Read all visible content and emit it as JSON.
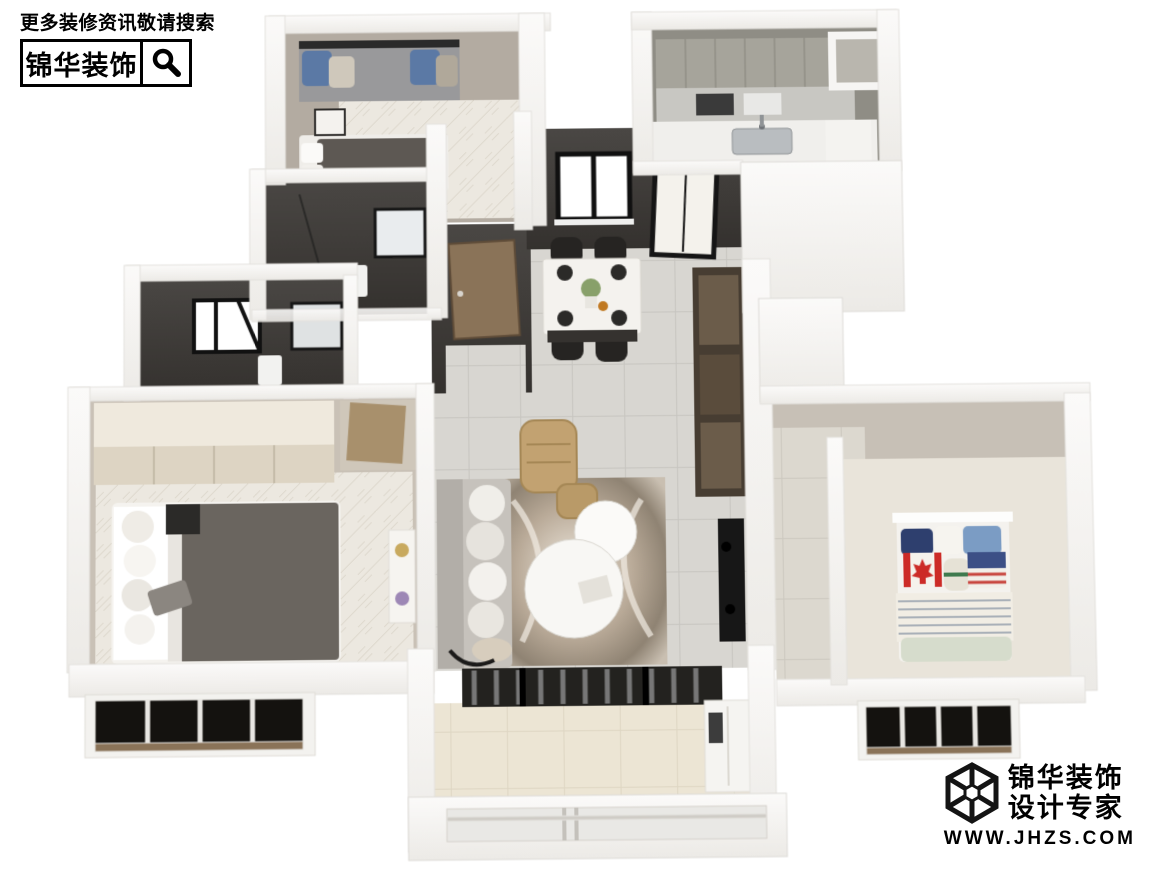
{
  "watermark_top": {
    "tagline": "更多装修资讯敬请搜索",
    "brand": "锦华装饰",
    "icon": "magnifier-icon"
  },
  "watermark_bottom": {
    "brand_line1": "锦华装饰",
    "brand_line2": "设计专家",
    "url": "WWW.JHZS.COM",
    "icon": "cube-wireframe-logo"
  },
  "colors": {
    "background": "#ffffff",
    "wall_white": "#f6f5f3",
    "wall_white_edge": "#e3e1dd",
    "wall_dark_charcoal": "#3f3c39",
    "wall_taupe": "#b3aba1",
    "floor_tile_gray": "#d8d6d1",
    "floor_herringbone": "#ece8e0",
    "floor_balcony_beige": "#ece5d4",
    "cabinet_brown": "#473d32",
    "door_wood": "#8a7358",
    "leather_tan": "#c2a271",
    "bed_blanket_gray": "#5d5853",
    "watermark_text": "#000000"
  },
  "scene": {
    "type": "3d-apartment-floorplan-render",
    "view": "bird-eye-dollhouse",
    "rooms": [
      {
        "id": "bedroom-north",
        "furniture": [
          "bay-window-seat",
          "blue-pillows",
          "double-bed",
          "nightstand",
          "wall-tv"
        ]
      },
      {
        "id": "bathroom-guest",
        "furniture": [
          "mirror",
          "toilet",
          "shower-glass"
        ]
      },
      {
        "id": "bathroom-master",
        "furniture": [
          "skylight-window",
          "mirror",
          "toilet"
        ]
      },
      {
        "id": "bedroom-master",
        "furniture": [
          "wardrobe",
          "double-bed",
          "nightstand",
          "plant-shelf",
          "bay-window"
        ]
      },
      {
        "id": "entry-hall",
        "furniture": [
          "wood-entry-door"
        ]
      },
      {
        "id": "dining-room",
        "furniture": [
          "marble-dining-table",
          "black-chairs-x4",
          "place-settings",
          "window"
        ]
      },
      {
        "id": "kitchen",
        "furniture": [
          "cabinets",
          "counter",
          "sink",
          "glass-door",
          "service-shaft"
        ]
      },
      {
        "id": "living-room",
        "furniture": [
          "sofa",
          "lounge-chair",
          "ottoman",
          "round-coffee-tables",
          "abstract-rug",
          "wall-tv",
          "floor-lamp"
        ]
      },
      {
        "id": "hallway-storage",
        "furniture": [
          "brown-cabinet-wall"
        ]
      },
      {
        "id": "bedroom-kids",
        "furniture": [
          "single-bed",
          "striped-duvet",
          "canada-flag-pillow",
          "usa-flag-pillow",
          "blue-pillows",
          "headboard-shelf",
          "bay-window"
        ]
      },
      {
        "id": "balcony",
        "furniture": [
          "sliding-glass-doors",
          "curtains",
          "storage-cabinet",
          "exterior-window-band"
        ]
      }
    ]
  }
}
